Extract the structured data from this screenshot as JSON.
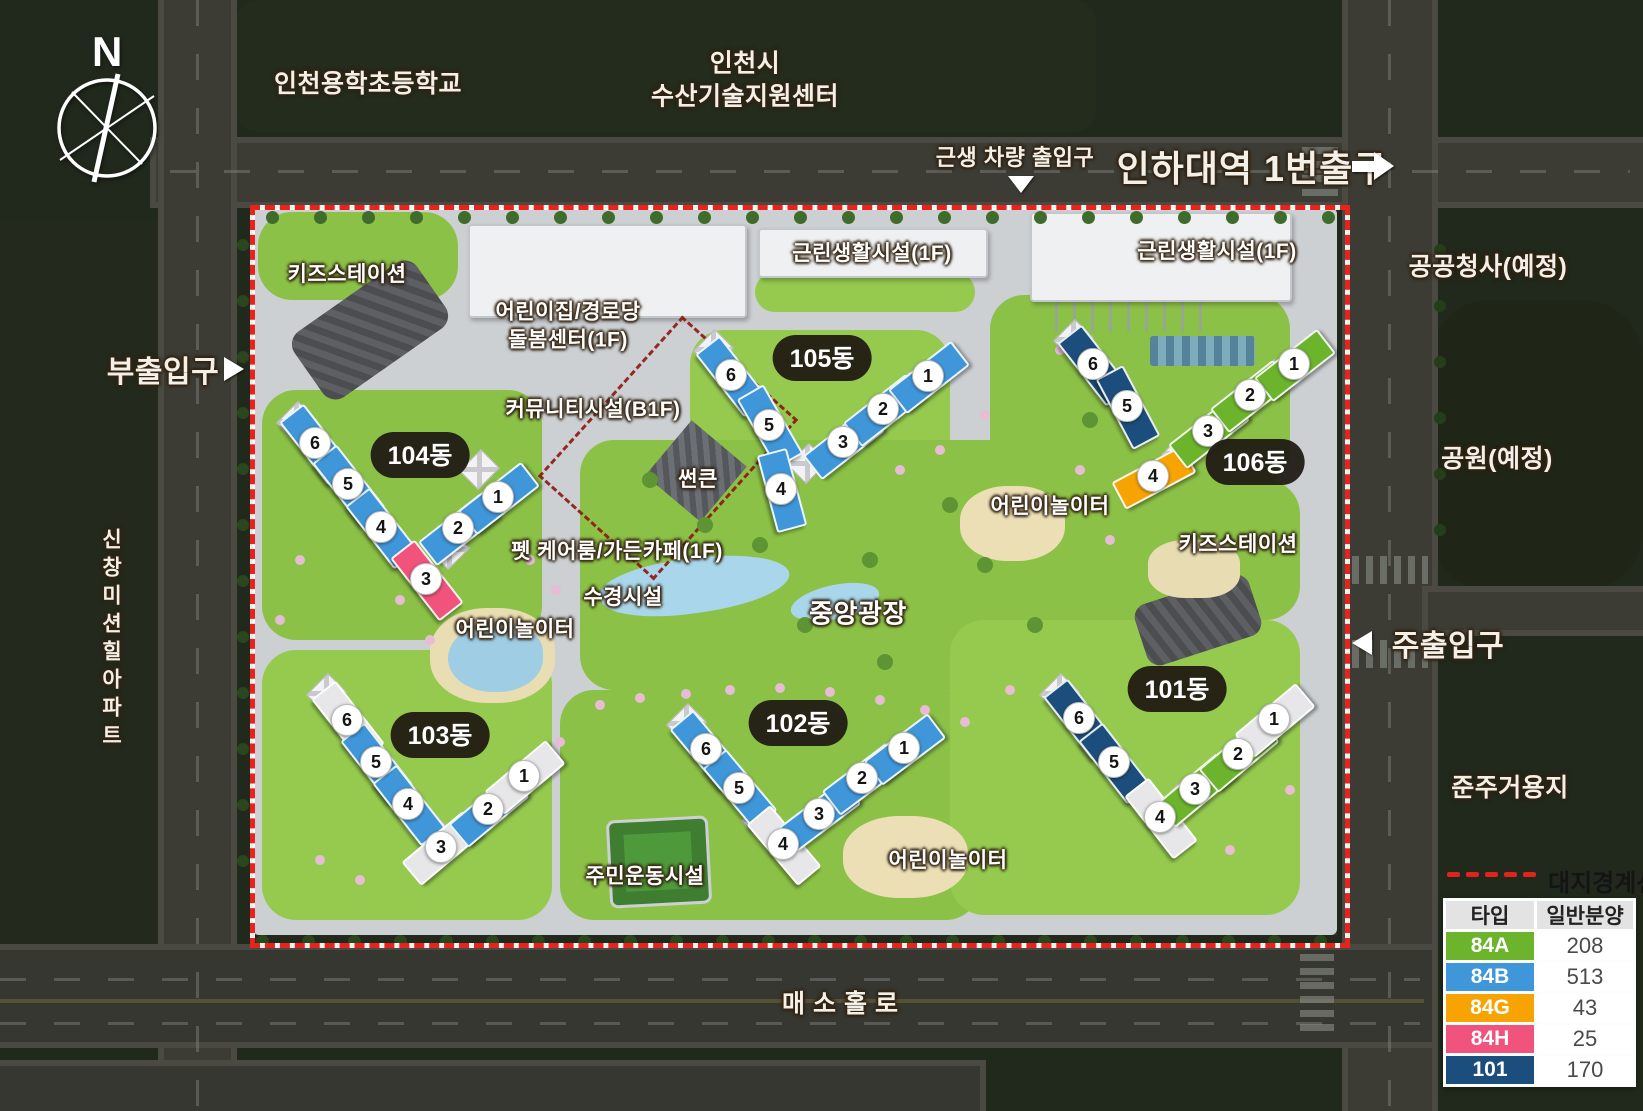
{
  "compass": {
    "north_label": "N"
  },
  "surroundings": {
    "school": "인천용학초등학교",
    "fisheries_line1": "인천시",
    "fisheries_line2": "수산기술지원센터",
    "public_office_planned": "공공청사(예정)",
    "park_planned": "공원(예정)",
    "neighbor_apartment": "신창미션힐아파트",
    "semi_residential": "준주거용지",
    "south_road": "매소홀로"
  },
  "entrances": {
    "station_exit": "인하대역 1번출구",
    "retail_vehicle": "근생 차량 출입구",
    "sub_entrance": "부출입구",
    "main_entrance": "주출입구"
  },
  "site_facilities": {
    "kids_station_nw": "키즈스테이션",
    "kids_station_e": "키즈스테이션",
    "daycare_line1": "어린이집/경로당",
    "daycare_line2": "돌봄센터(1F)",
    "community_b1f": "커뮤니티시설(B1F)",
    "sunken": "썬큰",
    "retail_a": "근린생활시설(1F)",
    "retail_b": "근린생활시설(1F)",
    "pet_care_cafe": "펫 케어룸/가든카페(1F)",
    "water_feature": "수경시설",
    "central_plaza": "중앙광장",
    "playground_w": "어린이놀이터",
    "playground_e": "어린이놀이터",
    "playground_s": "어린이놀이터",
    "residents_exercise": "주민운동시설"
  },
  "type_colors": {
    "84A": "#6cb42c",
    "84B": "#3f96d9",
    "84G": "#f7a402",
    "84H": "#f0537b",
    "101": "#1c4e7d",
    "etc": "#e7e7e9"
  },
  "boundary_color": "#e8231b",
  "buildings": [
    {
      "label": "104동",
      "pill": [
        420,
        455
      ],
      "cores": [
        [
          295,
          420
        ],
        [
          448,
          548
        ],
        [
          478,
          468
        ]
      ],
      "units": [
        {
          "n": "6",
          "t": "84B",
          "x": 314,
          "y": 442,
          "a": 52
        },
        {
          "n": "5",
          "t": "84B",
          "x": 347,
          "y": 483,
          "a": 52
        },
        {
          "n": "4",
          "t": "84B",
          "x": 380,
          "y": 526,
          "a": 52
        },
        {
          "n": "3",
          "t": "84H",
          "x": 425,
          "y": 578,
          "a": 52
        },
        {
          "n": "2",
          "t": "84B",
          "x": 457,
          "y": 527,
          "a": -38
        },
        {
          "n": "1",
          "t": "84B",
          "x": 497,
          "y": 496,
          "a": -38
        }
      ]
    },
    {
      "label": "105동",
      "pill": [
        822,
        358
      ],
      "cores": [
        [
          712,
          348
        ],
        [
          806,
          462
        ],
        [
          906,
          391
        ]
      ],
      "units": [
        {
          "n": "6",
          "t": "84B",
          "x": 730,
          "y": 374,
          "a": 52
        },
        {
          "n": "5",
          "t": "84B",
          "x": 768,
          "y": 424,
          "a": 60
        },
        {
          "n": "4",
          "t": "84B",
          "x": 780,
          "y": 488,
          "a": 75
        },
        {
          "n": "3",
          "t": "84B",
          "x": 842,
          "y": 441,
          "a": -38
        },
        {
          "n": "2",
          "t": "84B",
          "x": 882,
          "y": 408,
          "a": -38
        },
        {
          "n": "1",
          "t": "84B",
          "x": 927,
          "y": 375,
          "a": -38
        }
      ]
    },
    {
      "label": "106동",
      "pill": [
        1255,
        462
      ],
      "cores": [
        [
          1072,
          338
        ],
        [
          1180,
          452
        ],
        [
          1271,
          378
        ]
      ],
      "units": [
        {
          "n": "6",
          "t": "101",
          "x": 1092,
          "y": 363,
          "a": 52
        },
        {
          "n": "5",
          "t": "101",
          "x": 1126,
          "y": 405,
          "a": 62
        },
        {
          "n": "4",
          "t": "84G",
          "x": 1152,
          "y": 475,
          "a": -28
        },
        {
          "n": "3",
          "t": "84A",
          "x": 1207,
          "y": 430,
          "a": -38
        },
        {
          "n": "2",
          "t": "84A",
          "x": 1249,
          "y": 394,
          "a": -38
        },
        {
          "n": "1",
          "t": "84A",
          "x": 1293,
          "y": 363,
          "a": -38
        }
      ]
    },
    {
      "label": "103동",
      "pill": [
        440,
        735
      ],
      "cores": [
        [
          325,
          692
        ],
        [
          425,
          826
        ],
        [
          505,
          790
        ]
      ],
      "units": [
        {
          "n": "6",
          "t": "etc",
          "x": 346,
          "y": 719,
          "a": 52
        },
        {
          "n": "5",
          "t": "84B",
          "x": 375,
          "y": 761,
          "a": 52
        },
        {
          "n": "4",
          "t": "84B",
          "x": 407,
          "y": 803,
          "a": 52
        },
        {
          "n": "3",
          "t": "etc",
          "x": 440,
          "y": 846,
          "a": -40
        },
        {
          "n": "2",
          "t": "84B",
          "x": 487,
          "y": 808,
          "a": -40
        },
        {
          "n": "1",
          "t": "etc",
          "x": 523,
          "y": 775,
          "a": -40
        }
      ]
    },
    {
      "label": "102동",
      "pill": [
        798,
        723
      ],
      "cores": [
        [
          685,
          722
        ],
        [
          760,
          818
        ],
        [
          882,
          762
        ]
      ],
      "units": [
        {
          "n": "6",
          "t": "84B",
          "x": 705,
          "y": 748,
          "a": 50
        },
        {
          "n": "5",
          "t": "84B",
          "x": 738,
          "y": 787,
          "a": 50
        },
        {
          "n": "4",
          "t": "etc",
          "x": 782,
          "y": 843,
          "a": 50
        },
        {
          "n": "3",
          "t": "84B",
          "x": 818,
          "y": 813,
          "a": -37
        },
        {
          "n": "2",
          "t": "84B",
          "x": 861,
          "y": 777,
          "a": -37
        },
        {
          "n": "1",
          "t": "84B",
          "x": 903,
          "y": 747,
          "a": -37
        }
      ]
    },
    {
      "label": "101동",
      "pill": [
        1177,
        689
      ],
      "cores": [
        [
          1058,
          692
        ],
        [
          1178,
          800
        ],
        [
          1255,
          734
        ]
      ],
      "units": [
        {
          "n": "6",
          "t": "101",
          "x": 1078,
          "y": 717,
          "a": 52
        },
        {
          "n": "5",
          "t": "101",
          "x": 1113,
          "y": 761,
          "a": 52
        },
        {
          "n": "4",
          "t": "etc",
          "x": 1159,
          "y": 816,
          "a": 52
        },
        {
          "n": "3",
          "t": "84A",
          "x": 1194,
          "y": 788,
          "a": -40
        },
        {
          "n": "2",
          "t": "84A",
          "x": 1237,
          "y": 753,
          "a": -40
        },
        {
          "n": "1",
          "t": "etc",
          "x": 1273,
          "y": 718,
          "a": -40
        }
      ]
    }
  ],
  "legend": {
    "boundary_label": "대지경계선",
    "table": {
      "headers": [
        "타입",
        "일반분양"
      ],
      "rows": [
        {
          "type": "84A",
          "count": "208",
          "color": "#6cb42c"
        },
        {
          "type": "84B",
          "count": "513",
          "color": "#3f96d9"
        },
        {
          "type": "84G",
          "count": "43",
          "color": "#f7a402"
        },
        {
          "type": "84H",
          "count": "25",
          "color": "#f0537b"
        },
        {
          "type": "101",
          "count": "170",
          "color": "#1c4e7d"
        }
      ]
    }
  }
}
